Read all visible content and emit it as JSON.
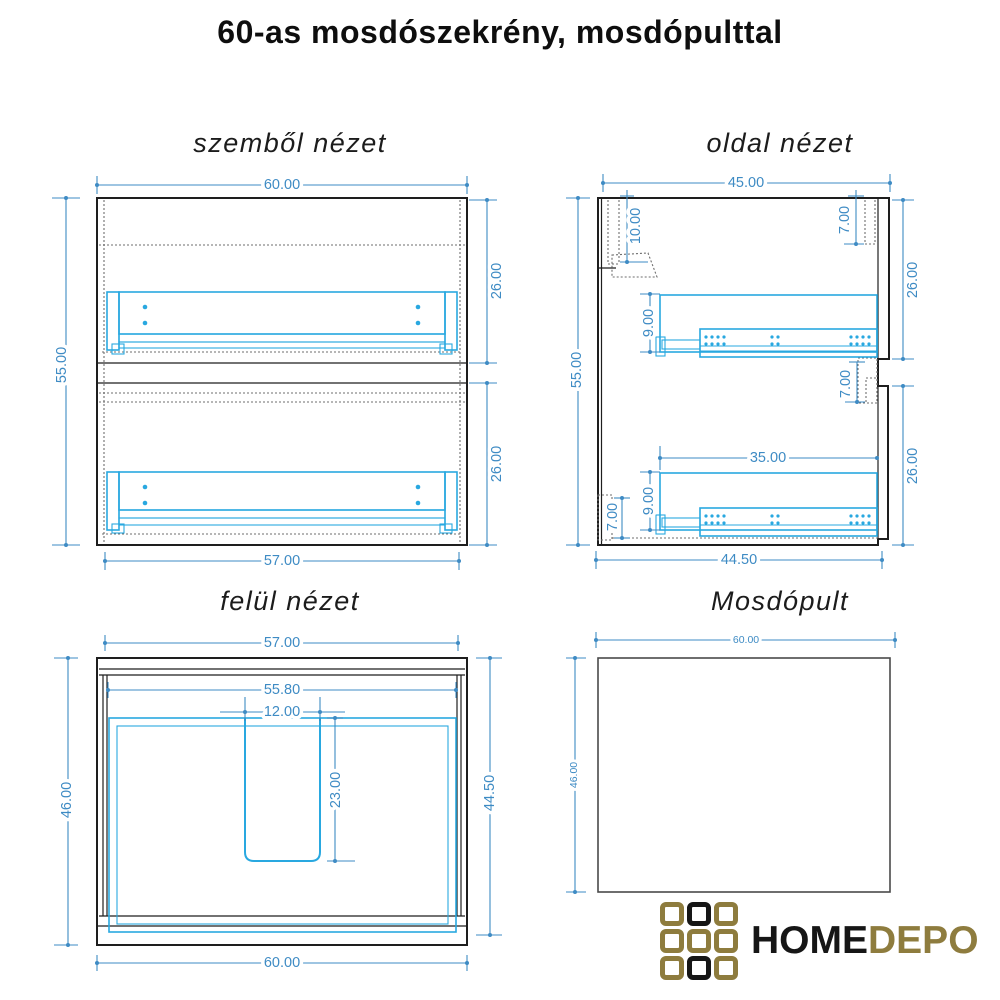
{
  "page_title": "60-as mosdószekrény, mosdópulttal",
  "colors": {
    "dimension_blue": "#3e8bc4",
    "hardware_cyan": "#29a8e0",
    "outline_black": "#1e1e1e",
    "hidden_line_gray": "#6e6e6e",
    "logo_gold": "#8e7c3e",
    "logo_black": "#161616"
  },
  "views": {
    "front": {
      "title": "szemből nézet",
      "dims": {
        "width_top": "60.00",
        "height_left": "55.00",
        "drawer_upper": "26.00",
        "drawer_lower": "26.00",
        "width_bottom": "57.00"
      }
    },
    "side": {
      "title": "oldal nézet",
      "dims": {
        "depth_top": "45.00",
        "height_left": "55.00",
        "bracket_offset": "10.00",
        "front_top_inset": "7.00",
        "section_upper": "26.00",
        "rail_upper": "9.00",
        "front_gap": "7.00",
        "rail_length": "35.00",
        "rail_lower": "9.00",
        "plinth": "7.00",
        "section_lower": "26.00",
        "depth_bottom": "44.50"
      }
    },
    "top": {
      "title": "felül nézet",
      "dims": {
        "width_top": "57.00",
        "width_inner": "55.80",
        "cutout_width": "12.00",
        "cutout_depth": "23.00",
        "depth_left": "46.00",
        "depth_right": "44.50",
        "width_bottom": "60.00"
      }
    },
    "pult": {
      "title": "Mosdópult",
      "dims": {
        "width_top": "60.00",
        "depth_left": "46.00"
      }
    }
  },
  "logo": {
    "home": "HOME",
    "depo": "DEPO"
  }
}
